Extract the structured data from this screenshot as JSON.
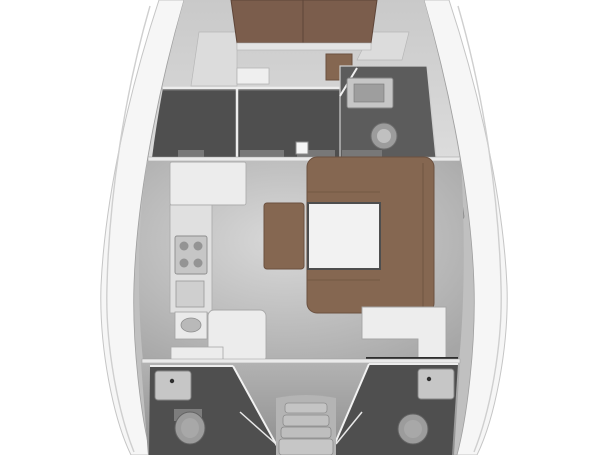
{
  "plan": {
    "kind": "sailing-yacht-interior-floorplan",
    "orientation": "bow-at-top",
    "rooms": [
      {
        "name": "forward-cabin",
        "features": [
          "v-berth-double-bed",
          "bed-center-seam",
          "foot-board",
          "side-shelves",
          "seat",
          "brown-ottoman",
          "wardrobe-floor"
        ]
      },
      {
        "name": "forward-head",
        "features": [
          "sink",
          "toilet",
          "door-opening"
        ]
      },
      {
        "name": "salon",
        "features": [
          "u-shaped-sofa",
          "square-table",
          "bench-seat",
          "mast-post"
        ]
      },
      {
        "name": "galley",
        "features": [
          "counter-top",
          "stove-four-burners",
          "oven",
          "sink",
          "l-shaped-counter"
        ]
      },
      {
        "name": "nav-station",
        "features": [
          "l-shaped-chart-table"
        ]
      },
      {
        "name": "aft-head-port",
        "features": [
          "sink",
          "toilet"
        ]
      },
      {
        "name": "aft-head-starboard",
        "features": [
          "sink",
          "toilet"
        ]
      },
      {
        "name": "aft-cabin-port",
        "features": [
          "double-berth"
        ]
      },
      {
        "name": "aft-cabin-starboard",
        "features": [
          "double-berth"
        ]
      },
      {
        "name": "companionway",
        "steps": 4
      }
    ],
    "deck_fittings": [
      "port-midship-cleat",
      "starboard-midship-cleat",
      "toe-rail-lines"
    ]
  },
  "palette": {
    "background": "#ffffff",
    "hull": "#f6f6f6",
    "hull_line": "#c5c5c5",
    "deck_band": "#ececec",
    "liner": "#c0c0c0",
    "shelf_light": "#d2d2d2",
    "wall": "#ededed",
    "floor_dark": "#4f4f4f",
    "head_floor": "#5c5c5c",
    "bed_brown": "#7b5d4c",
    "upholstery_brown": "#856751",
    "upholstery_edge": "#6b5140",
    "table_white": "#f2f2f2",
    "counter_white": "#ececec",
    "appliance_gray": "#c6c6c6",
    "fixture_gray": "#9c9c9c",
    "stair_gray": "#c4c4c4",
    "aft_floor": "#a2a2a2",
    "accent_dark": "#2e2e2e"
  }
}
